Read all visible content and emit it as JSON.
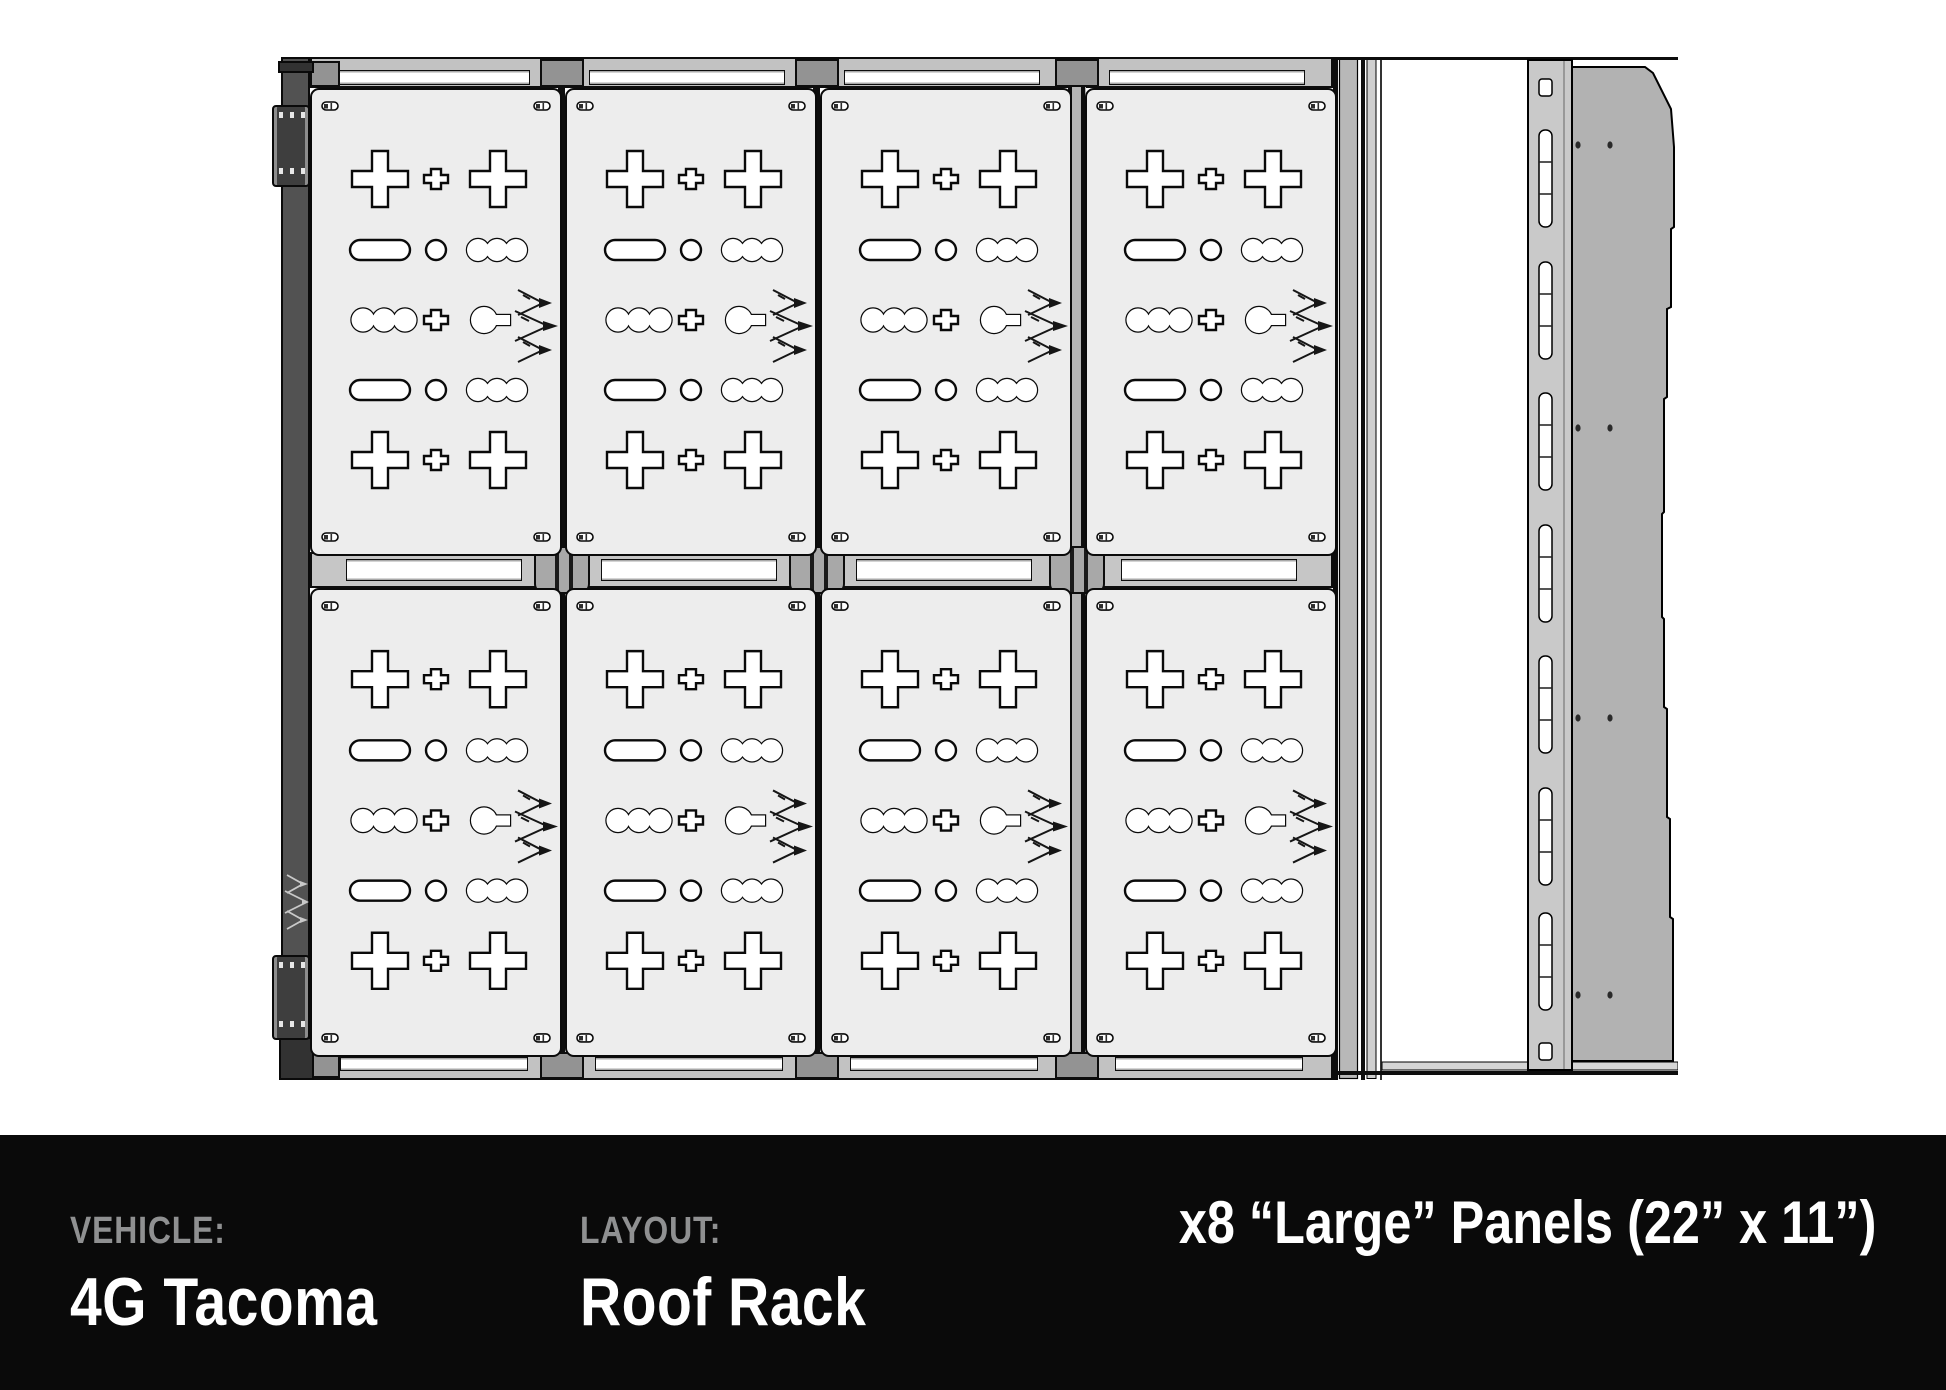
{
  "colors": {
    "background": "#ffffff",
    "footer_bg": "#0a0a0a",
    "label_gray": "#8f9091",
    "value_white": "#ffffff",
    "panel_fill": "#ededed",
    "frame_dark": "#525252",
    "bracket_dark": "#3e3e3e",
    "bar_gray": "#c2c2c2",
    "rail_gray": "#c9c9c9",
    "flap_gray": "#b2b2b2"
  },
  "footer": {
    "vehicle_label": "VEHICLE:",
    "vehicle_value": "4G Tacoma",
    "layout_label": "LAYOUT:",
    "layout_value": "Roof Rack",
    "panels_summary": "x8 “Large” Panels (22” x 11”)"
  },
  "diagram": {
    "panel_count": 8,
    "grid_rows": 2,
    "grid_cols": 4
  }
}
